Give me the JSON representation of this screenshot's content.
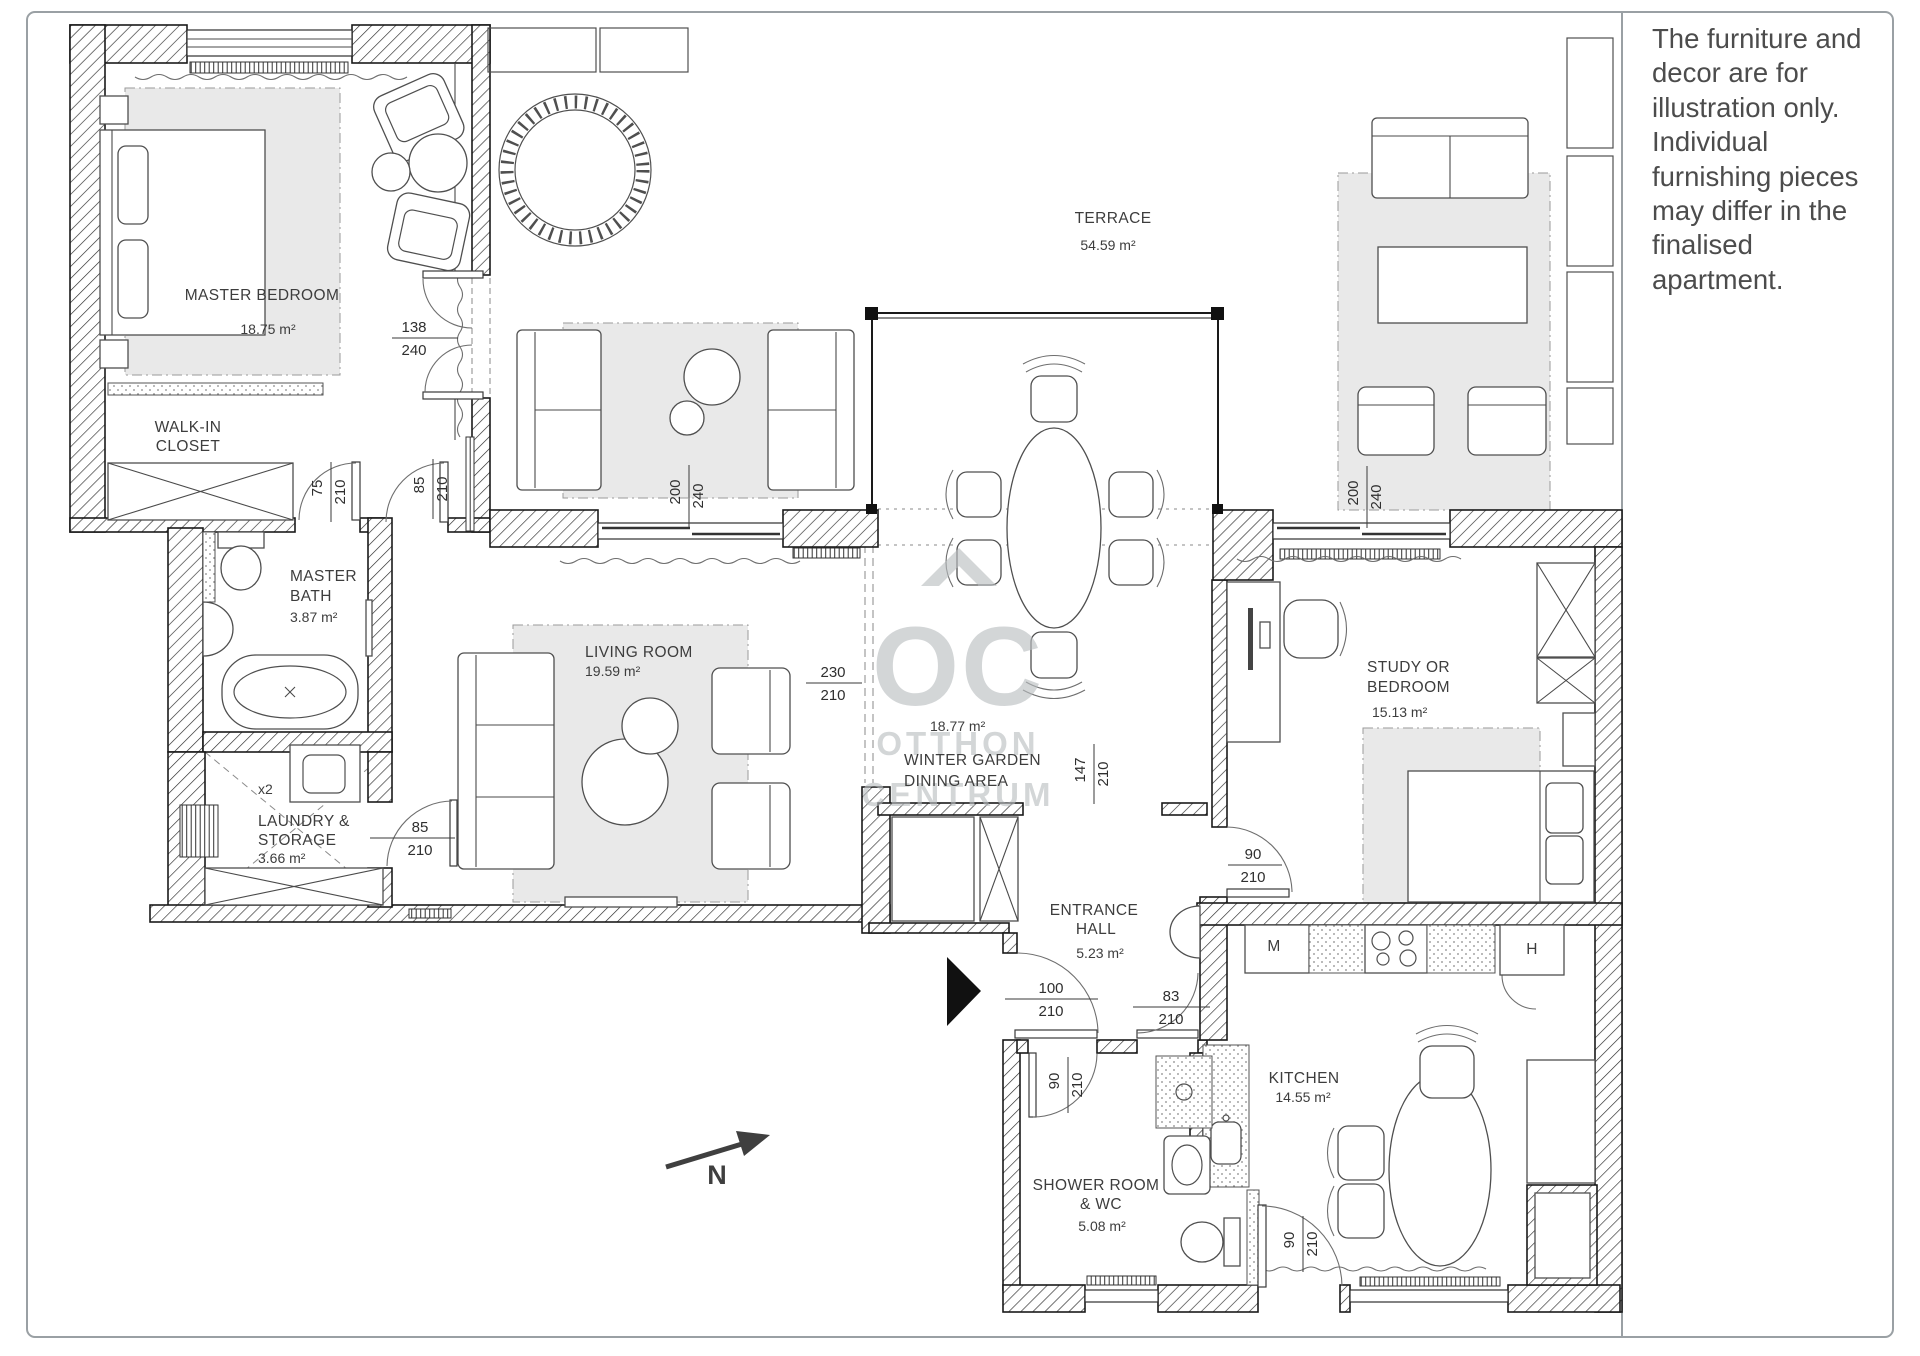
{
  "disclaimer": "The furniture and decor are for illustration only. Individual furnishing pieces may differ in the finalised apartment.",
  "watermark": {
    "oc": "OC",
    "otthon": "OTTHON",
    "centrum": "CENTRUM"
  },
  "compass": {
    "label": "N"
  },
  "rooms": {
    "master_bedroom": {
      "name": "MASTER BEDROOM",
      "area": "18.75 m²"
    },
    "walk_in_closet": {
      "name1": "WALK-IN",
      "name2": "CLOSET"
    },
    "master_bath": {
      "name1": "MASTER",
      "name2": "BATH",
      "area": "3.87 m²"
    },
    "laundry": {
      "name1": "LAUNDRY &",
      "name2": "STORAGE",
      "area": "3.66 m²"
    },
    "living_room": {
      "name": "LIVING ROOM",
      "area": "19.59 m²"
    },
    "terrace": {
      "name": "TERRACE",
      "area": "54.59 m²"
    },
    "winter_garden": {
      "area": "18.77 m²",
      "name1": "WINTER GARDEN",
      "name2": "DINING AREA"
    },
    "study": {
      "name1": "STUDY OR",
      "name2": "BEDROOM",
      "area": "15.13 m²"
    },
    "entrance_hall": {
      "name1": "ENTRANCE",
      "name2": "HALL",
      "area": "5.23 m²"
    },
    "kitchen": {
      "name": "KITCHEN",
      "area": "14.55 m²"
    },
    "shower_room": {
      "name1": "SHOWER ROOM",
      "name2": "& WC",
      "area": "5.08 m²"
    }
  },
  "appliances": {
    "dishwasher": "M",
    "fridge": "H",
    "washer_note": "x2"
  },
  "dimensions": [
    {
      "w": "138",
      "h": "240"
    },
    {
      "w": "75",
      "h": "210"
    },
    {
      "w": "85",
      "h": "210"
    },
    {
      "w": "200",
      "h": "240"
    },
    {
      "w": "85",
      "h": "210"
    },
    {
      "w": "230",
      "h": "210"
    },
    {
      "w": "147",
      "h": "210"
    },
    {
      "w": "200",
      "h": "240"
    },
    {
      "w": "90",
      "h": "210"
    },
    {
      "w": "100",
      "h": "210"
    },
    {
      "w": "83",
      "h": "210"
    },
    {
      "w": "90",
      "h": "210"
    },
    {
      "w": "90",
      "h": "210"
    }
  ]
}
